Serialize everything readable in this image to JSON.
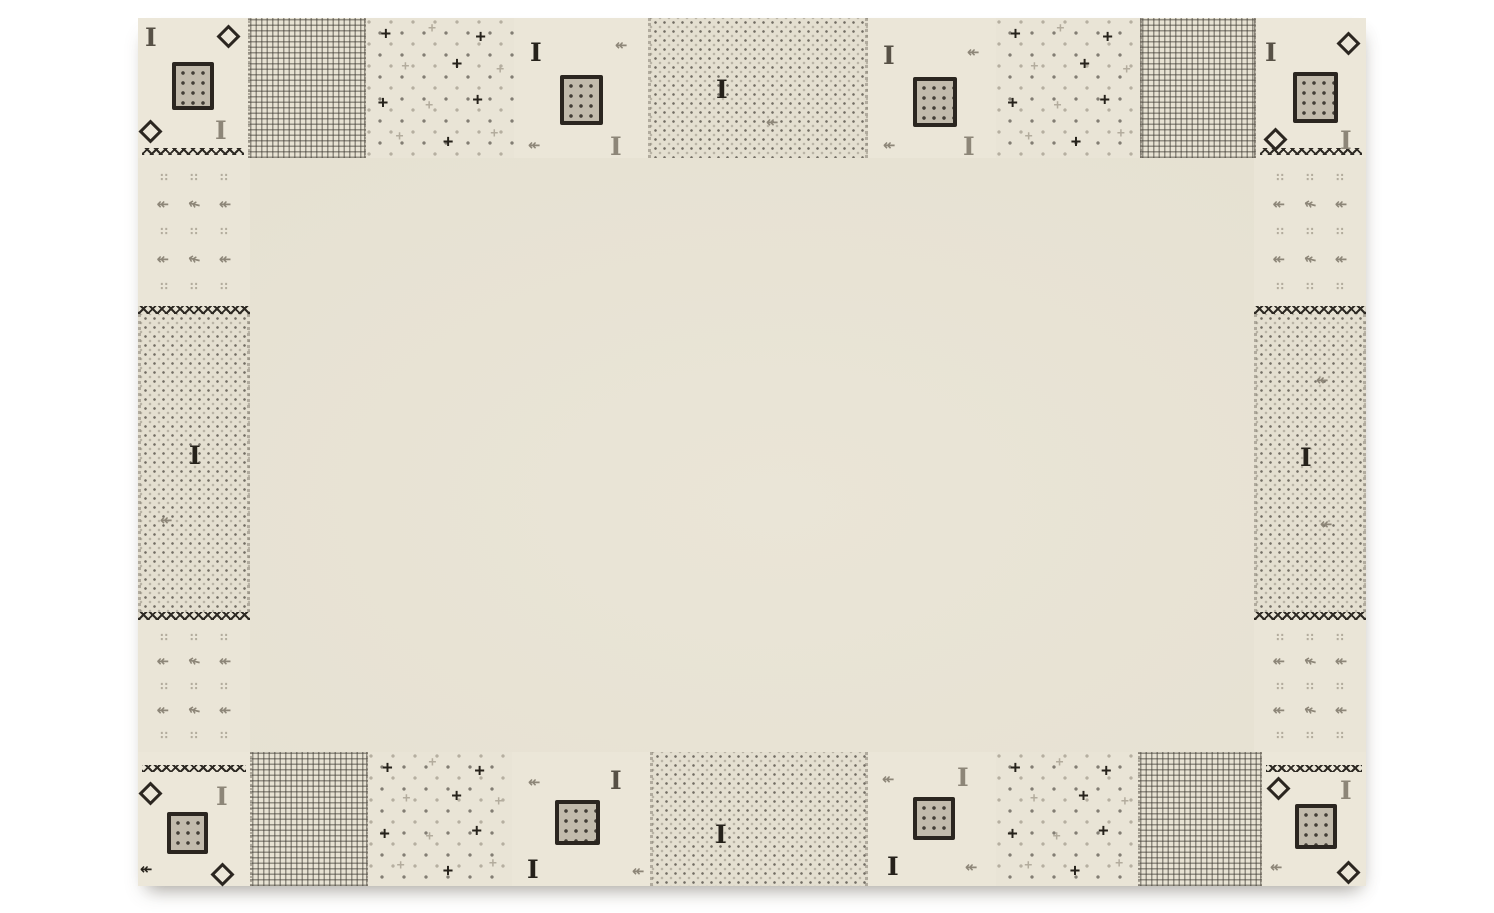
{
  "image": {
    "description": "Product photograph of a cream wool rug with a tribal patchwork border of grey squares, diamonds, crosses, arrows and dotted patches on a white background",
    "background_color": "#ffffff"
  },
  "rug": {
    "x": 138,
    "y": 18,
    "width": 1228,
    "height": 868,
    "colors": {
      "dark": "#26221b",
      "darkgray": "#575146",
      "gray": "#8d8678",
      "lite": "#b3ac9d",
      "taupe": "#c2bbac",
      "outline": "#2b2620",
      "field": "#e6e1d2",
      "patch_cream": "#ebe6d8",
      "speckle_bg": "#e4dfd0"
    },
    "glyphs": {
      "i_motif": "I",
      "arrow_motif": "↞",
      "dots_motif": "∷",
      "plus_motif": "+"
    },
    "sections": [
      {
        "id": "corner-tl",
        "type": "corner",
        "x": 0,
        "y": 0,
        "w": 110,
        "h": 140,
        "zigzag": "bottom",
        "motifs": [
          {
            "kind": "i",
            "x": 7,
            "y": 7,
            "color": "darkgray"
          },
          {
            "kind": "diamond",
            "x": 82,
            "y": 10
          },
          {
            "kind": "square",
            "x": 34,
            "y": 44,
            "w": 42,
            "h": 48
          },
          {
            "kind": "diamond",
            "x": 4,
            "y": 105
          },
          {
            "kind": "i",
            "x": 77,
            "y": 100,
            "color": "gray"
          }
        ]
      },
      {
        "id": "top-grid-1",
        "type": "grid",
        "x": 110,
        "y": 0,
        "w": 118,
        "h": 140,
        "motifs": []
      },
      {
        "id": "top-dotsplus-1",
        "type": "dotsplus",
        "x": 228,
        "y": 0,
        "w": 148,
        "h": 140,
        "motifs": []
      },
      {
        "id": "top-plain-1",
        "type": "plain",
        "x": 376,
        "y": 0,
        "w": 134,
        "h": 140,
        "motifs": [
          {
            "kind": "i",
            "x": 16,
            "y": 22,
            "color": "dark"
          },
          {
            "kind": "arrow",
            "x": 101,
            "y": 20,
            "color": "gray"
          },
          {
            "kind": "square",
            "x": 46,
            "y": 57,
            "w": 43,
            "h": 50
          },
          {
            "kind": "arrow",
            "x": 14,
            "y": 120,
            "color": "gray"
          },
          {
            "kind": "i",
            "x": 96,
            "y": 116,
            "color": "gray"
          }
        ]
      },
      {
        "id": "top-speckle",
        "type": "speckle",
        "x": 510,
        "y": 0,
        "w": 220,
        "h": 140,
        "motifs": [
          {
            "kind": "i",
            "x": 65,
            "y": 59,
            "color": "dark"
          },
          {
            "kind": "arrow",
            "x": 115,
            "y": 97,
            "color": "gray"
          }
        ]
      },
      {
        "id": "top-plain-2",
        "type": "plain",
        "x": 730,
        "y": 0,
        "w": 128,
        "h": 140,
        "motifs": [
          {
            "kind": "i",
            "x": 15,
            "y": 25,
            "color": "darkgray"
          },
          {
            "kind": "arrow",
            "x": 99,
            "y": 27,
            "color": "gray"
          },
          {
            "kind": "square",
            "x": 45,
            "y": 59,
            "w": 44,
            "h": 50
          },
          {
            "kind": "arrow",
            "x": 15,
            "y": 120,
            "color": "gray"
          },
          {
            "kind": "i",
            "x": 95,
            "y": 116,
            "color": "gray"
          }
        ]
      },
      {
        "id": "top-dotsplus-2",
        "type": "dotsplus",
        "x": 858,
        "y": 0,
        "w": 144,
        "h": 140,
        "motifs": []
      },
      {
        "id": "top-grid-2",
        "type": "grid",
        "x": 1002,
        "y": 0,
        "w": 116,
        "h": 140,
        "motifs": []
      },
      {
        "id": "corner-tr",
        "type": "corner",
        "x": 1118,
        "y": 0,
        "w": 110,
        "h": 140,
        "zigzag": "bottom",
        "motifs": [
          {
            "kind": "i",
            "x": 9,
            "y": 22,
            "color": "darkgray"
          },
          {
            "kind": "diamond",
            "x": 84,
            "y": 17
          },
          {
            "kind": "square",
            "x": 37,
            "y": 54,
            "w": 45,
            "h": 51
          },
          {
            "kind": "diamond",
            "x": 11,
            "y": 113
          },
          {
            "kind": "i",
            "x": 84,
            "y": 110,
            "color": "gray"
          }
        ]
      },
      {
        "id": "left-arrows-1",
        "type": "arrows",
        "x": 0,
        "y": 140,
        "w": 112,
        "h": 148,
        "motifs": []
      },
      {
        "id": "left-zigzag-1",
        "type": "zigzag",
        "x": 0,
        "y": 288,
        "w": 112,
        "h": 8
      },
      {
        "id": "left-speckle",
        "type": "speckle",
        "x": 0,
        "y": 296,
        "w": 112,
        "h": 298,
        "motifs": [
          {
            "kind": "i",
            "x": 48,
            "y": 129,
            "color": "dark"
          },
          {
            "kind": "arrow",
            "x": 19,
            "y": 199,
            "color": "gray"
          }
        ]
      },
      {
        "id": "left-zigzag-2",
        "type": "zigzag",
        "x": 0,
        "y": 594,
        "w": 112,
        "h": 8
      },
      {
        "id": "left-arrows-2",
        "type": "arrows",
        "x": 0,
        "y": 602,
        "w": 112,
        "h": 132,
        "motifs": []
      },
      {
        "id": "right-arrows-1",
        "type": "arrows",
        "x": 1116,
        "y": 140,
        "w": 112,
        "h": 148,
        "motifs": []
      },
      {
        "id": "right-zigzag-1",
        "type": "zigzag",
        "x": 1116,
        "y": 288,
        "w": 112,
        "h": 8
      },
      {
        "id": "right-speckle",
        "type": "speckle",
        "x": 1116,
        "y": 296,
        "w": 112,
        "h": 298,
        "motifs": [
          {
            "kind": "arrow",
            "x": 59,
            "y": 59,
            "color": "gray"
          },
          {
            "kind": "i",
            "x": 43,
            "y": 131,
            "color": "dark"
          },
          {
            "kind": "arrow",
            "x": 63,
            "y": 203,
            "color": "gray"
          }
        ]
      },
      {
        "id": "right-zigzag-2",
        "type": "zigzag",
        "x": 1116,
        "y": 594,
        "w": 112,
        "h": 8
      },
      {
        "id": "right-arrows-2",
        "type": "arrows",
        "x": 1116,
        "y": 602,
        "w": 112,
        "h": 132,
        "motifs": []
      },
      {
        "id": "corner-bl",
        "type": "corner",
        "x": 0,
        "y": 734,
        "w": 112,
        "h": 134,
        "zigzag": "top",
        "motifs": [
          {
            "kind": "diamond",
            "x": 4,
            "y": 33
          },
          {
            "kind": "i",
            "x": 78,
            "y": 32,
            "color": "gray"
          },
          {
            "kind": "square",
            "x": 29,
            "y": 60,
            "w": 41,
            "h": 42
          },
          {
            "kind": "arrow",
            "x": 2,
            "y": 110,
            "color": "dark"
          },
          {
            "kind": "diamond",
            "x": 76,
            "y": 114
          }
        ]
      },
      {
        "id": "bottom-grid-1",
        "type": "grid",
        "x": 112,
        "y": 734,
        "w": 118,
        "h": 134,
        "motifs": []
      },
      {
        "id": "bottom-dotsplus-1",
        "type": "dotsplus",
        "x": 230,
        "y": 734,
        "w": 144,
        "h": 134,
        "motifs": []
      },
      {
        "id": "bottom-plain-1",
        "type": "plain",
        "x": 374,
        "y": 734,
        "w": 138,
        "h": 134,
        "motifs": [
          {
            "kind": "arrow",
            "x": 16,
            "y": 23,
            "color": "gray"
          },
          {
            "kind": "i",
            "x": 98,
            "y": 16,
            "color": "darkgray"
          },
          {
            "kind": "square",
            "x": 43,
            "y": 48,
            "w": 45,
            "h": 45
          },
          {
            "kind": "i",
            "x": 15,
            "y": 105,
            "color": "dark"
          },
          {
            "kind": "arrow",
            "x": 120,
            "y": 112,
            "color": "gray"
          }
        ]
      },
      {
        "id": "bottom-speckle",
        "type": "speckle",
        "x": 512,
        "y": 734,
        "w": 218,
        "h": 134,
        "motifs": [
          {
            "kind": "i",
            "x": 62,
            "y": 70,
            "color": "dark"
          }
        ]
      },
      {
        "id": "bottom-plain-2",
        "type": "plain",
        "x": 730,
        "y": 734,
        "w": 128,
        "h": 134,
        "motifs": [
          {
            "kind": "arrow",
            "x": 14,
            "y": 20,
            "color": "gray"
          },
          {
            "kind": "i",
            "x": 89,
            "y": 13,
            "color": "gray"
          },
          {
            "kind": "square",
            "x": 45,
            "y": 45,
            "w": 42,
            "h": 43
          },
          {
            "kind": "i",
            "x": 19,
            "y": 102,
            "color": "dark"
          },
          {
            "kind": "arrow",
            "x": 97,
            "y": 108,
            "color": "gray"
          }
        ]
      },
      {
        "id": "bottom-dotsplus-2",
        "type": "dotsplus",
        "x": 858,
        "y": 734,
        "w": 142,
        "h": 134,
        "motifs": []
      },
      {
        "id": "bottom-grid-2",
        "type": "grid",
        "x": 1000,
        "y": 734,
        "w": 124,
        "h": 134,
        "motifs": []
      },
      {
        "id": "corner-br",
        "type": "corner",
        "x": 1124,
        "y": 734,
        "w": 104,
        "h": 134,
        "zigzag": "top",
        "motifs": [
          {
            "kind": "diamond",
            "x": 8,
            "y": 28
          },
          {
            "kind": "i",
            "x": 78,
            "y": 26,
            "color": "gray"
          },
          {
            "kind": "square",
            "x": 33,
            "y": 52,
            "w": 42,
            "h": 45
          },
          {
            "kind": "arrow",
            "x": 8,
            "y": 108,
            "color": "gray"
          },
          {
            "kind": "diamond",
            "x": 78,
            "y": 112
          }
        ]
      }
    ]
  }
}
